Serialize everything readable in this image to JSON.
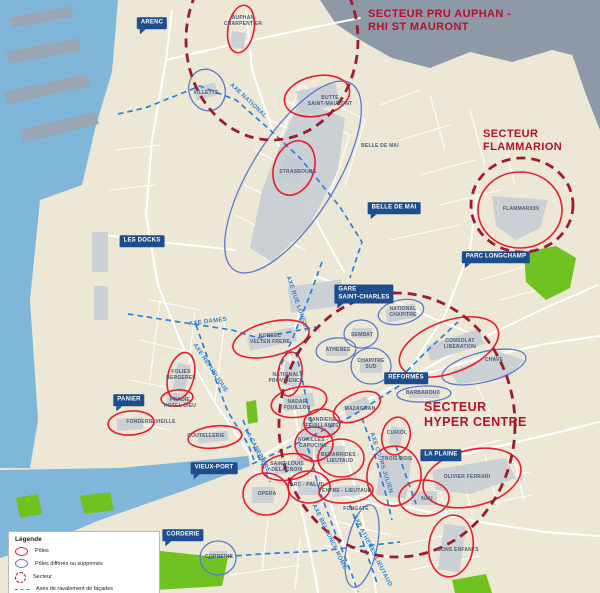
{
  "colors": {
    "land": "#ece8d5",
    "water": "#7fb6d9",
    "infra": "#8e99a7",
    "pier": "#9aa6b3",
    "block": "#c6cbd3",
    "park": "#6fc220",
    "street": "#ffffff",
    "pole": "#e81c2e",
    "pole_deferred": "#5b79c8",
    "sector": "#9c1b31",
    "sector_title": "#b5102c",
    "axis": "#2e7fd8",
    "label_box": "#1d4d8c",
    "label_box_text": "#ffffff",
    "map_label": "#4d5d70",
    "legend_text": "#222222"
  },
  "legend": {
    "title": "Légende",
    "items": [
      {
        "icon": "pole-ellipse-icon",
        "label": "Pôles"
      },
      {
        "icon": "deferred-ellipse-icon",
        "label": "Pôles différés ou supprimés"
      },
      {
        "icon": "sector-dashed-circle-icon",
        "label": "Secteur"
      },
      {
        "icon": "axis-dashed-line-icon",
        "label": "Axes de ravalement de façades"
      }
    ]
  },
  "sector_titles": [
    {
      "name": "secteur-pru-auphan-rhi-st-mauront",
      "text": "SECTEUR PRU AUPHAN -\nRHI ST MAURONT",
      "x": 368,
      "y": 8,
      "size": 11
    },
    {
      "name": "secteur-flammarion",
      "text": "SECTEUR\nFLAMMARION",
      "x": 483,
      "y": 128,
      "size": 11
    },
    {
      "name": "secteur-hyper-centre",
      "text": "SECTEUR\nHYPER CENTRE",
      "x": 424,
      "y": 400,
      "size": 12.5
    }
  ],
  "boxed_labels": [
    {
      "text": "ARENC",
      "x": 152,
      "y": 23,
      "tail": true
    },
    {
      "text": "LES DOCKS",
      "x": 142,
      "y": 241,
      "tail": false
    },
    {
      "text": "GARE\nSAINT-CHARLES",
      "x": 364,
      "y": 294,
      "tail": true
    },
    {
      "text": "BELLE DE MAI",
      "x": 394,
      "y": 208,
      "tail": true
    },
    {
      "text": "PARC LONGCHAMP",
      "x": 496,
      "y": 257,
      "tail": true
    },
    {
      "text": "RÉFORMÉS",
      "x": 406,
      "y": 378,
      "tail": false
    },
    {
      "text": "PANIER",
      "x": 129,
      "y": 400,
      "tail": true
    },
    {
      "text": "VIEUX-PORT",
      "x": 214,
      "y": 468,
      "tail": true
    },
    {
      "text": "LA PLAINE",
      "x": 441,
      "y": 455,
      "tail": false
    },
    {
      "text": "CORDERIE",
      "x": 183,
      "y": 535,
      "tail": true
    }
  ],
  "place_labels": [
    {
      "text": "AUPHAN\nCHARPENTIER",
      "x": 243,
      "y": 21
    },
    {
      "text": "VILLETTE",
      "x": 206,
      "y": 93
    },
    {
      "text": "BUTTE\nSAINT-MAURONT",
      "x": 330,
      "y": 101
    },
    {
      "text": "BELLE DE MAI",
      "x": 380,
      "y": 146
    },
    {
      "text": "STRASBOURG",
      "x": 298,
      "y": 172
    },
    {
      "text": "FLAMMARION",
      "x": 521,
      "y": 209
    },
    {
      "text": "NATIONAL\nCHAPITRE",
      "x": 403,
      "y": 312
    },
    {
      "text": "SEMBAT",
      "x": 362,
      "y": 335
    },
    {
      "text": "ATHENES",
      "x": 338,
      "y": 350
    },
    {
      "text": "CHAPITRE\nSUD",
      "x": 371,
      "y": 364
    },
    {
      "text": "KORSEC\nVELTEN FRERE",
      "x": 270,
      "y": 339
    },
    {
      "text": "FOLIES\nBERGERES",
      "x": 181,
      "y": 375
    },
    {
      "text": "PRADIE\nHOTEL DIEU",
      "x": 180,
      "y": 403
    },
    {
      "text": "FONDERIE VIEILLE",
      "x": 151,
      "y": 422
    },
    {
      "text": "COUTELLERIE",
      "x": 206,
      "y": 436
    },
    {
      "text": "NATIONAL\nPROVIDENCE",
      "x": 286,
      "y": 378
    },
    {
      "text": "NADAR\nFOUILLON",
      "x": 297,
      "y": 405
    },
    {
      "text": "MAZAGRAN",
      "x": 360,
      "y": 409
    },
    {
      "text": "BANDIERE\nFEUILLANTS",
      "x": 322,
      "y": 423
    },
    {
      "text": "NOAILLES -\nCAPUCINS",
      "x": 313,
      "y": 443
    },
    {
      "text": "BEDARRIDES -\nLIEUTAUD",
      "x": 340,
      "y": 458
    },
    {
      "text": "SAINT-LOUIS\nDELACROIX",
      "x": 287,
      "y": 467
    },
    {
      "text": "ARC - PALUD",
      "x": 307,
      "y": 485
    },
    {
      "text": "VENTRE - LIEUTAUD",
      "x": 345,
      "y": 491
    },
    {
      "text": "FONGATE",
      "x": 356,
      "y": 509
    },
    {
      "text": "OPERA",
      "x": 267,
      "y": 494
    },
    {
      "text": "CURIOL",
      "x": 397,
      "y": 433
    },
    {
      "text": "CONSOLAT\nLIBERATION",
      "x": 460,
      "y": 344
    },
    {
      "text": "CHAVE",
      "x": 494,
      "y": 360
    },
    {
      "text": "BARBAROUX",
      "x": 423,
      "y": 393
    },
    {
      "text": "TROIS ROIS",
      "x": 397,
      "y": 459
    },
    {
      "text": "OLIVIER FERRARI",
      "x": 467,
      "y": 477
    },
    {
      "text": "NAU",
      "x": 427,
      "y": 499
    },
    {
      "text": "BONS ENFANTS",
      "x": 458,
      "y": 550
    },
    {
      "text": "CORDERIE",
      "x": 219,
      "y": 557
    }
  ],
  "axis_labels": [
    {
      "text": "AXE NATIONAL",
      "x": 248,
      "y": 101,
      "rot": 43
    },
    {
      "text": "AXE DAMES",
      "x": 208,
      "y": 322,
      "rot": -7
    },
    {
      "text": "AXE RÉPUBLIQUE",
      "x": 210,
      "y": 368,
      "rot": 56
    },
    {
      "text": "AXE RUE LONGUE",
      "x": 297,
      "y": 304,
      "rot": 71
    },
    {
      "text": "LA CANEBIERE",
      "x": 257,
      "y": 451,
      "rot": 62
    },
    {
      "text": "AXE COURS JULIEN",
      "x": 381,
      "y": 463,
      "rot": 72
    },
    {
      "text": "AXE BELSUNCE ROME",
      "x": 329,
      "y": 537,
      "rot": 64
    },
    {
      "text": "AXE ATHENES LIEUTAUD",
      "x": 372,
      "y": 551,
      "rot": 63
    }
  ],
  "poles": [
    {
      "name": "auphan-charpentier",
      "cx": 241,
      "cy": 29,
      "rx": 13,
      "ry": 24,
      "rot": 10
    },
    {
      "name": "butte-saint-mauront",
      "cx": 317,
      "cy": 96,
      "rx": 33,
      "ry": 20,
      "rot": -12
    },
    {
      "name": "strasbourg",
      "cx": 294,
      "cy": 168,
      "rx": 20,
      "ry": 28,
      "rot": 20
    },
    {
      "name": "flammarion",
      "cx": 520,
      "cy": 210,
      "rx": 42,
      "ry": 38,
      "rot": 0
    },
    {
      "name": "korsec-velten-frere",
      "cx": 271,
      "cy": 339,
      "rx": 39,
      "ry": 17,
      "rot": -14
    },
    {
      "name": "folies-bergeres",
      "cx": 181,
      "cy": 376,
      "rx": 13,
      "ry": 24,
      "rot": 14
    },
    {
      "name": "pradie-hotel-dieu",
      "cx": 177,
      "cy": 398,
      "rx": 16,
      "ry": 8,
      "rot": -6
    },
    {
      "name": "fonderie-vieille",
      "cx": 131,
      "cy": 423,
      "rx": 23,
      "ry": 12,
      "rot": -4
    },
    {
      "name": "coutellerie",
      "cx": 215,
      "cy": 437,
      "rx": 27,
      "ry": 11,
      "rot": -6
    },
    {
      "name": "national-providence",
      "cx": 290,
      "cy": 374,
      "rx": 12,
      "ry": 22,
      "rot": 6
    },
    {
      "name": "nadar-fouillon",
      "cx": 299,
      "cy": 402,
      "rx": 28,
      "ry": 15,
      "rot": -10
    },
    {
      "name": "mazagran",
      "cx": 357,
      "cy": 407,
      "rx": 25,
      "ry": 13,
      "rot": -24
    },
    {
      "name": "bandiere-feuillants",
      "cx": 322,
      "cy": 423,
      "rx": 18,
      "ry": 14,
      "rot": 0
    },
    {
      "name": "noailles-capucins",
      "cx": 314,
      "cy": 444,
      "rx": 19,
      "ry": 17,
      "rot": 0
    },
    {
      "name": "bedarrides-lieutaud",
      "cx": 341,
      "cy": 458,
      "rx": 23,
      "ry": 19,
      "rot": 0
    },
    {
      "name": "saint-louis-delacroix",
      "cx": 288,
      "cy": 467,
      "rx": 26,
      "ry": 13,
      "rot": -8
    },
    {
      "name": "arc-palud",
      "cx": 309,
      "cy": 487,
      "rx": 21,
      "ry": 16,
      "rot": 0
    },
    {
      "name": "ventre-lieutaud",
      "cx": 346,
      "cy": 491,
      "rx": 27,
      "ry": 12,
      "rot": -4
    },
    {
      "name": "opera",
      "cx": 266,
      "cy": 494,
      "rx": 23,
      "ry": 21,
      "rot": 0
    },
    {
      "name": "curiol",
      "cx": 396,
      "cy": 436,
      "rx": 14,
      "ry": 19,
      "rot": 12
    },
    {
      "name": "consolat-liberation",
      "cx": 449,
      "cy": 347,
      "rx": 52,
      "ry": 26,
      "rot": -20
    },
    {
      "name": "trois-rois",
      "cx": 394,
      "cy": 476,
      "rx": 27,
      "ry": 30,
      "rot": 8
    },
    {
      "name": "nau",
      "cx": 424,
      "cy": 498,
      "rx": 25,
      "ry": 18,
      "rot": 0
    },
    {
      "name": "olivier-ferrari",
      "cx": 472,
      "cy": 478,
      "rx": 50,
      "ry": 28,
      "rot": -14
    },
    {
      "name": "bons-enfants",
      "cx": 451,
      "cy": 546,
      "rx": 22,
      "ry": 31,
      "rot": 8
    }
  ],
  "poles_deferred": [
    {
      "name": "villette",
      "cx": 207,
      "cy": 90,
      "rx": 18,
      "ry": 21,
      "rot": -18
    },
    {
      "name": "belle-de-mai",
      "cx": 293,
      "cy": 177,
      "rx": 42,
      "ry": 110,
      "rot": 32
    },
    {
      "name": "national-chapitre",
      "cx": 401,
      "cy": 312,
      "rx": 23,
      "ry": 12,
      "rot": -12
    },
    {
      "name": "sembat",
      "cx": 361,
      "cy": 334,
      "rx": 17,
      "ry": 14,
      "rot": 0
    },
    {
      "name": "athenes",
      "cx": 336,
      "cy": 350,
      "rx": 20,
      "ry": 12,
      "rot": -6
    },
    {
      "name": "chapitre-sud",
      "cx": 371,
      "cy": 366,
      "rx": 20,
      "ry": 18,
      "rot": 0
    },
    {
      "name": "chave",
      "cx": 484,
      "cy": 367,
      "rx": 43,
      "ry": 15,
      "rot": -14
    },
    {
      "name": "barbaroux",
      "cx": 424,
      "cy": 394,
      "rx": 27,
      "ry": 8,
      "rot": -2
    },
    {
      "name": "corderie",
      "cx": 218,
      "cy": 558,
      "rx": 18,
      "ry": 17,
      "rot": 0
    },
    {
      "name": "athenes-lieutaud",
      "cx": 362,
      "cy": 546,
      "rx": 15,
      "ry": 42,
      "rot": 12
    }
  ],
  "sector_outlines": [
    {
      "name": "secteur-pru-auphan-outline",
      "cx": 272,
      "cy": 40,
      "rx": 86,
      "ry": 100
    },
    {
      "name": "secteur-flammarion-outline",
      "cx": 522,
      "cy": 205,
      "rx": 51,
      "ry": 47
    },
    {
      "name": "secteur-hyper-centre-outline",
      "cx": 397,
      "cy": 425,
      "rx": 118,
      "ry": 132
    }
  ],
  "axes": [
    {
      "name": "axe-national",
      "points": "118,114 145,108 200,86 236,100 268,128 300,158 340,207 362,242 350,278"
    },
    {
      "name": "axe-dames",
      "points": "128,314 180,322 232,330 258,338"
    },
    {
      "name": "axe-dames-est",
      "points": "258,338 290,332 316,327"
    },
    {
      "name": "axe-republique",
      "points": "196,325 212,370 228,412 248,444 254,460"
    },
    {
      "name": "axe-rue-longue",
      "points": "322,262 308,300 292,340 278,372"
    },
    {
      "name": "la-canebiere-nord",
      "points": "243,420 256,452 270,482"
    },
    {
      "name": "la-canebiere",
      "points": "252,464 300,442 352,416 402,384"
    },
    {
      "name": "axe-liberation",
      "points": "400,378 430,348 458,322"
    },
    {
      "name": "axe-cours-julien",
      "points": "362,418 374,452 386,495 392,520"
    },
    {
      "name": "axe-belsunce-rome",
      "points": "308,448 320,492 336,535 352,575 358,592"
    },
    {
      "name": "axe-athenes-lieutaud",
      "points": "350,505 364,545 378,586"
    },
    {
      "name": "axe-belsunce-nord",
      "points": "296,352 304,388 312,424"
    },
    {
      "name": "axe-corderie-est",
      "points": "208,558 260,554 320,551 400,542"
    },
    {
      "name": "axe-la-plaine-sud",
      "points": "396,446 406,476 416,504"
    }
  ]
}
